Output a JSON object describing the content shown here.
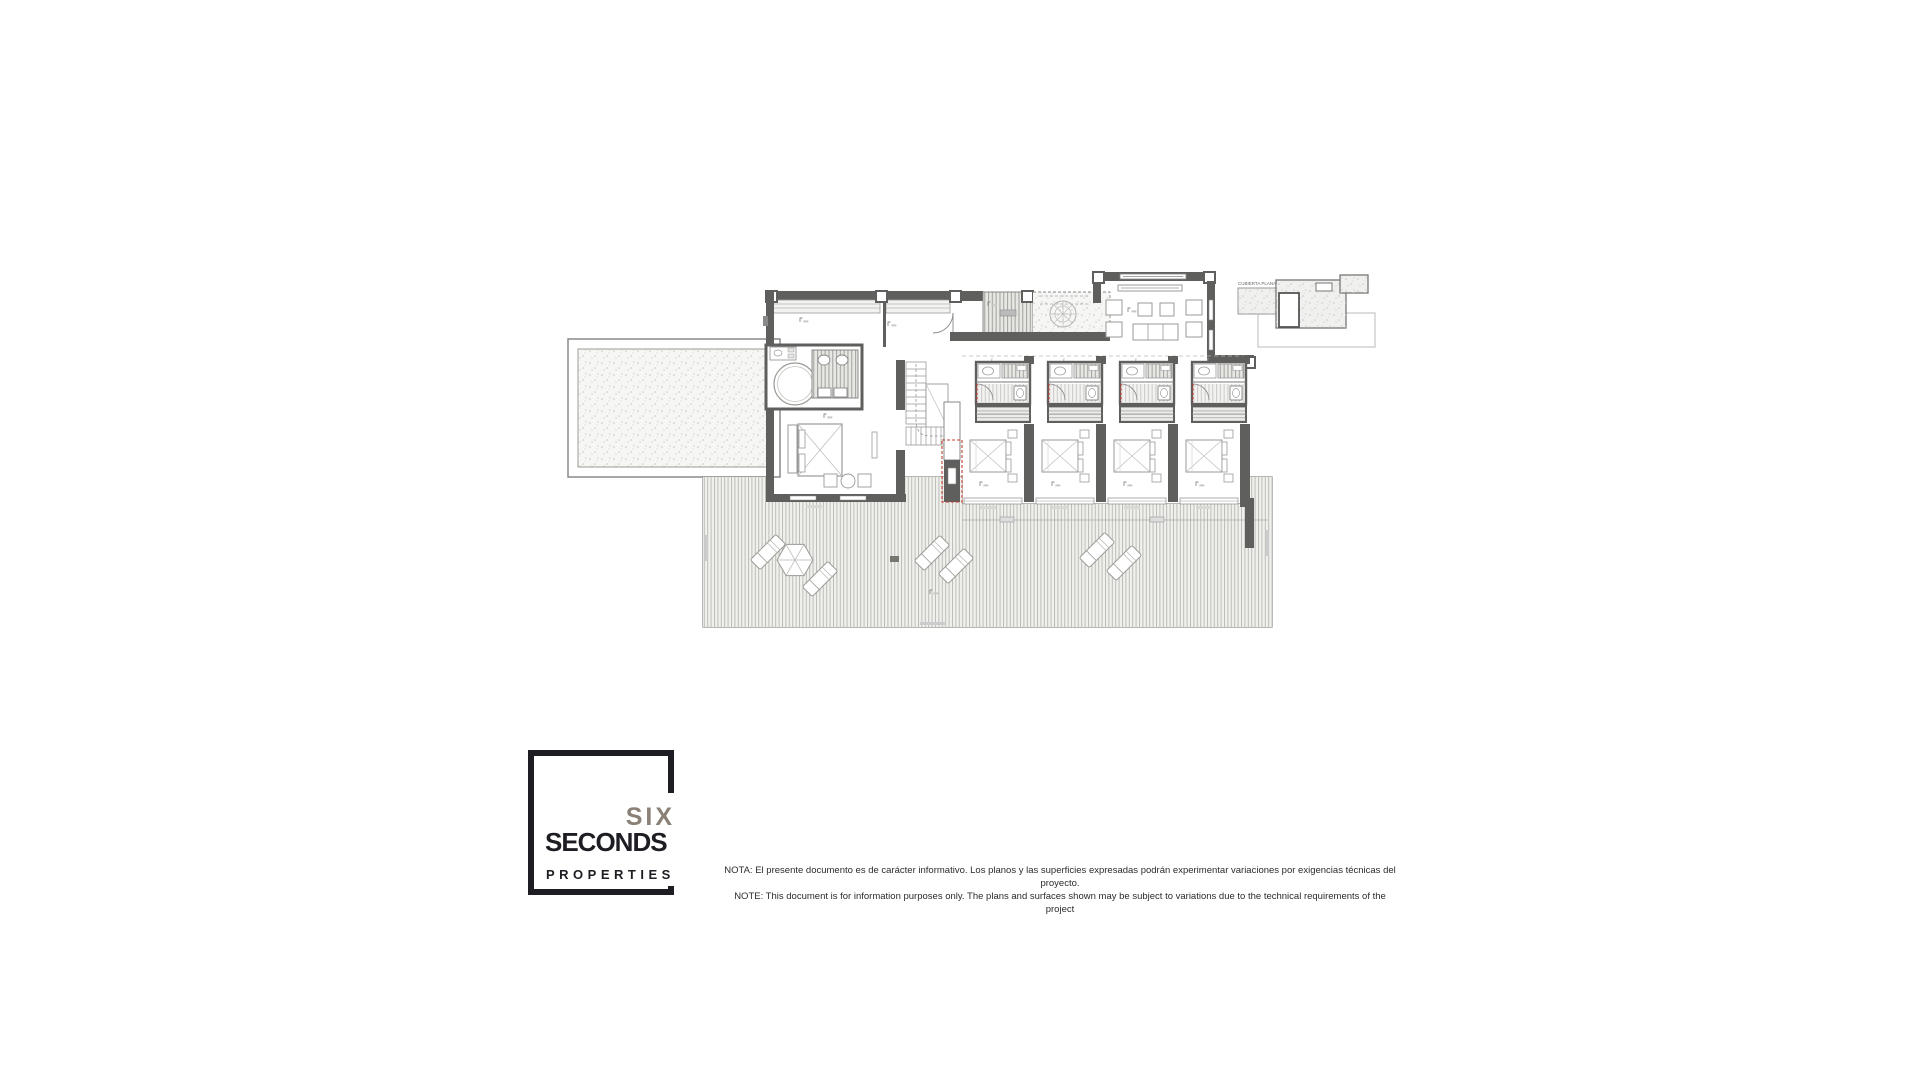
{
  "brand": {
    "line1": "SIX",
    "line2": "SECONDS",
    "line3": "PROPERTIES"
  },
  "disclaimer": {
    "es": "NOTA: El presente documento es de carácter informativo. Los planos y las superficies expresadas podrán experimentar variaciones por exigencias técnicas del proyecto.",
    "en": "NOTE: This document is for information purposes only. The plans and surfaces shown may be subject to variations due to the technical requirements of the project"
  },
  "plan": {
    "inset_label": "CUBIERTA PLANA"
  },
  "colors": {
    "wall": "#5f5f5d",
    "accent_red": "#c0392b",
    "logo_gray": "#8a8076",
    "logo_black": "#1d1d23"
  }
}
